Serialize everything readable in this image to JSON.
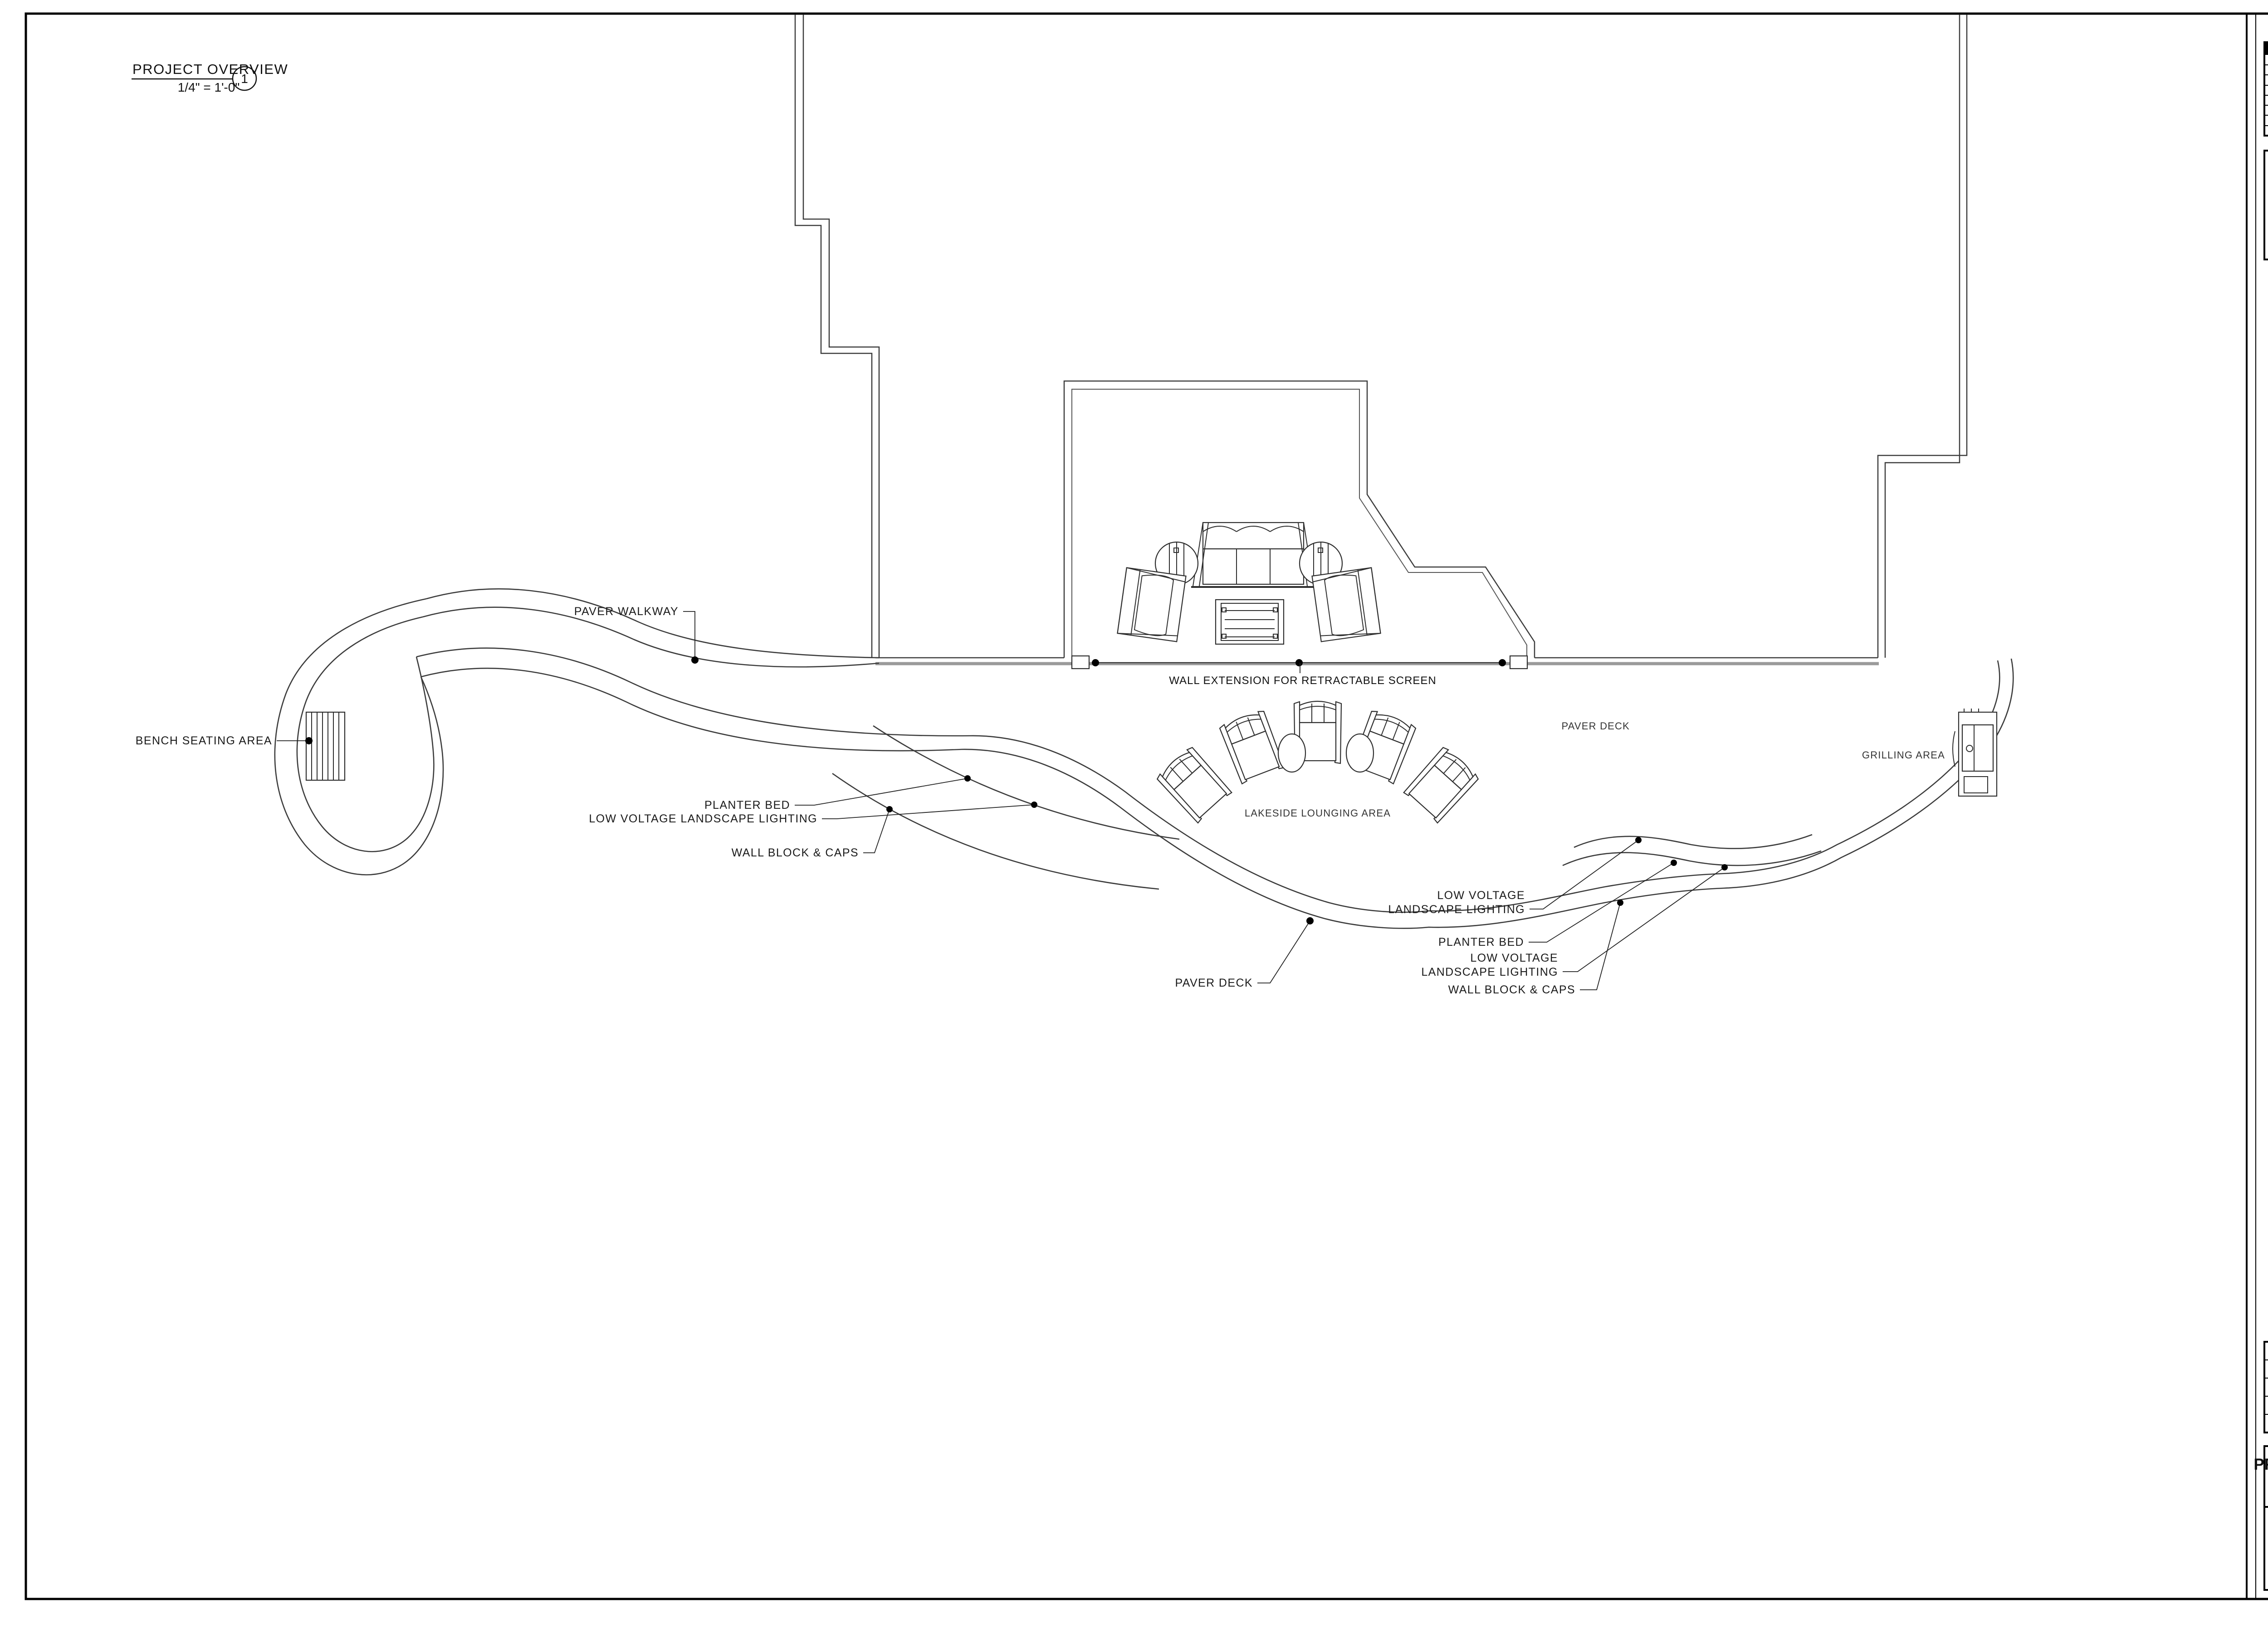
{
  "viewport": {
    "title": "PROJECT OVERVIEW",
    "scale": "1/4\" = 1'-0\"",
    "number": "1"
  },
  "titleblock": {
    "revision_table": {
      "col_date": "DATE",
      "col_revision": "REVISION",
      "empty_rows": 8
    },
    "copyright_lines": [
      "All of the Plans, Images",
      "and Content in this",
      "document are protected",
      "under United States",
      "copyright laws.",
      "Reproduction of the plans",
      "or images in any way is",
      "strictly prohibited."
    ],
    "brand": {
      "logo": "PRATT GUYS",
      "address_line": "14559 PHILIPS HWY. | JACKSONVILLE, FL 32256 | 904.737.4652 | CBC 056685 | CPC 056645"
    },
    "project": {
      "name": "LOVE RESIDENCE",
      "address1": "3826 Saltmeadow Court South",
      "address2": "Jacksonville, FL 32224"
    },
    "info_rows": [
      {
        "label": "PROJECT NO.",
        "value": "25030"
      },
      {
        "label": "DATE:",
        "value": "03/09/2026"
      },
      {
        "label": "DESIGN:",
        "value": "CHRIS EITEL"
      },
      {
        "label": "SALES:",
        "value": "BYRON GILBERT"
      },
      {
        "label": "SUPER:",
        "value": "TBD"
      }
    ],
    "sheet_title": "PROJECT OVERVIEW",
    "sheet_number": "A-7"
  },
  "plan_labels": {
    "paver_walkway": "PAVER WALKWAY",
    "bench_seating": "BENCH SEATING AREA",
    "planter_bed_left": "PLANTER BED",
    "lv_lighting_left": "LOW VOLTAGE LANDSCAPE LIGHTING",
    "wall_block_left": "WALL BLOCK & CAPS",
    "wall_extension": "WALL EXTENSION FOR RETRACTABLE SCREEN",
    "lakeside": "LAKESIDE LOUNGING AREA",
    "paver_deck_upper": "PAVER DECK",
    "grilling": "GRILLING AREA",
    "lv_r1_line1": "LOW VOLTAGE",
    "lv_r1_line2": "LANDSCAPE LIGHTING",
    "planter_bed_right": "PLANTER BED",
    "lv_r2_line1": "LOW VOLTAGE",
    "lv_r2_line2": "LANDSCAPE LIGHTING",
    "wall_block_right": "WALL BLOCK & CAPS",
    "paver_deck_bottom": "PAVER DECK"
  },
  "colors": {
    "paper": "#ffffff",
    "line": "#3c3c3c",
    "wall_gray": "#9a9a9a",
    "ink": "#000000"
  }
}
